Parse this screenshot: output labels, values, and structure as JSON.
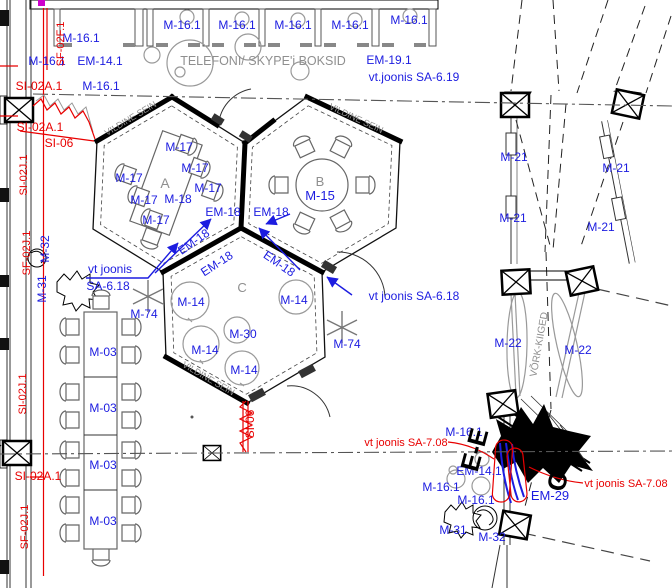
{
  "drawing_type": "architectural floor plan",
  "colors": {
    "annotation_blue": "#1c1ce0",
    "markup_red": "#e80000",
    "dim_gray": "#8f8f8f",
    "wall_black": "#000000",
    "revision_magenta": "#cc00cc"
  },
  "rooms": {
    "booths_title": "TELEFONI/ SKYPE'i BOKSID",
    "hex_a": "A",
    "hex_b": "B",
    "hex_c": "C",
    "felt_wall": "VILDINE SEIN",
    "net_swings": "VÕRK-KIIGED"
  },
  "labels": [
    {
      "n": "booth-label-1",
      "t": "M-16.1",
      "x": 182,
      "y": 29
    },
    {
      "n": "booth-label-2",
      "t": "M-16.1",
      "x": 237,
      "y": 29
    },
    {
      "n": "booth-label-3",
      "t": "M-16.1",
      "x": 293,
      "y": 29
    },
    {
      "n": "booth-label-4",
      "t": "M-16.1",
      "x": 350,
      "y": 29
    },
    {
      "n": "booth-label-5",
      "t": "M-16.1",
      "x": 409,
      "y": 24
    },
    {
      "n": "label-m16-a",
      "t": "M-16.1",
      "x": 81,
      "y": 42
    },
    {
      "n": "label-m16-b",
      "t": "M-16.1",
      "x": 47,
      "y": 65
    },
    {
      "n": "label-em14-top",
      "t": "EM-14.1",
      "x": 100,
      "y": 65
    },
    {
      "n": "label-m16-c",
      "t": "M-16.1",
      "x": 101,
      "y": 90
    },
    {
      "n": "label-si02a-top",
      "t": "SI-02A.1",
      "x": 39,
      "y": 90,
      "c": "r"
    },
    {
      "n": "room-title-booths",
      "t": "TELEFONI/ SKYPE'i BOKSID",
      "x": 263,
      "y": 65,
      "c": "g",
      "s": 12.5
    },
    {
      "n": "label-em19",
      "t": "EM-19.1",
      "x": 389,
      "y": 64
    },
    {
      "n": "label-sa619",
      "t": "vt.joonis SA-6.19",
      "x": 414,
      "y": 81
    },
    {
      "n": "wall-label-a",
      "t": "VILDINE SEIN",
      "x": 132,
      "y": 121,
      "r": -31,
      "c": "g",
      "s": 9
    },
    {
      "n": "wall-label-b",
      "t": "VILDINE SEIN",
      "x": 355,
      "y": 121,
      "r": 25,
      "c": "g",
      "s": 9
    },
    {
      "n": "wall-label-c",
      "t": "VILDINE SEIN",
      "x": 207,
      "y": 381,
      "r": 30,
      "c": "g",
      "s": 9
    },
    {
      "n": "room-letter-a",
      "t": "A",
      "x": 165,
      "y": 188,
      "c": "g",
      "s": 14
    },
    {
      "n": "room-letter-b",
      "t": "B",
      "x": 320,
      "y": 186,
      "c": "g",
      "s": 13
    },
    {
      "n": "room-letter-c",
      "t": "C",
      "x": 242,
      "y": 292,
      "c": "g",
      "s": 13
    },
    {
      "n": "label-m17-1",
      "t": "M-17",
      "x": 179,
      "y": 151
    },
    {
      "n": "label-m17-2",
      "t": "M-17",
      "x": 195,
      "y": 172
    },
    {
      "n": "label-m17-3",
      "t": "M-17",
      "x": 208,
      "y": 192
    },
    {
      "n": "label-m17-4",
      "t": "M-17",
      "x": 129,
      "y": 182
    },
    {
      "n": "label-m17-5",
      "t": "M-17",
      "x": 144,
      "y": 204
    },
    {
      "n": "label-m17-6",
      "t": "M-17",
      "x": 156,
      "y": 224
    },
    {
      "n": "label-m18",
      "t": "M-18",
      "x": 178,
      "y": 203
    },
    {
      "n": "label-m15",
      "t": "M-15",
      "x": 320,
      "y": 200,
      "s": 13
    },
    {
      "n": "label-em18-1",
      "t": "EM-18",
      "x": 223,
      "y": 216
    },
    {
      "n": "label-em18-2",
      "t": "EM-18",
      "x": 271,
      "y": 216
    },
    {
      "n": "label-em18-3",
      "t": "EM-18",
      "x": 196,
      "y": 245,
      "r": -35
    },
    {
      "n": "label-em18-4",
      "t": "EM-18",
      "x": 219,
      "y": 267,
      "r": -33
    },
    {
      "n": "label-em18-5",
      "t": "EM-18",
      "x": 277,
      "y": 267,
      "r": 35
    },
    {
      "n": "label-m14-1",
      "t": "M-14",
      "x": 191,
      "y": 306
    },
    {
      "n": "label-m14-2",
      "t": "M-14",
      "x": 294,
      "y": 304
    },
    {
      "n": "label-m14-3",
      "t": "M-14",
      "x": 205,
      "y": 354
    },
    {
      "n": "label-m14-4",
      "t": "M-14",
      "x": 244,
      "y": 374
    },
    {
      "n": "label-m30",
      "t": "M-30",
      "x": 243,
      "y": 338
    },
    {
      "n": "label-m74-left",
      "t": "M-74",
      "x": 144,
      "y": 318
    },
    {
      "n": "label-m74-right",
      "t": "M-74",
      "x": 347,
      "y": 348
    },
    {
      "n": "label-vtjoonis-left-1",
      "t": "vt joonis",
      "x": 110,
      "y": 273
    },
    {
      "n": "label-vtjoonis-left-2",
      "t": "SA-6.18",
      "x": 108,
      "y": 290
    },
    {
      "n": "label-vtjoonis-right",
      "t": "vt joonis SA-6.18",
      "x": 414,
      "y": 300
    },
    {
      "n": "label-m21-1",
      "t": "M-21",
      "x": 514,
      "y": 161
    },
    {
      "n": "label-m21-2",
      "t": "M-21",
      "x": 616,
      "y": 172
    },
    {
      "n": "label-m21-3",
      "t": "M-21",
      "x": 513,
      "y": 222
    },
    {
      "n": "label-m21-4",
      "t": "M-21",
      "x": 601,
      "y": 231
    },
    {
      "n": "label-m22-left",
      "t": "M-22",
      "x": 508,
      "y": 347
    },
    {
      "n": "label-m22-right",
      "t": "M-22",
      "x": 578,
      "y": 354
    },
    {
      "n": "label-vork-kiiged",
      "t": "VÕRK-KIIGED",
      "x": 542,
      "y": 345,
      "r": -80,
      "c": "g",
      "s": 10
    },
    {
      "n": "label-m03-1",
      "t": "M-03",
      "x": 103,
      "y": 356
    },
    {
      "n": "label-m03-2",
      "t": "M-03",
      "x": 103,
      "y": 412
    },
    {
      "n": "label-m03-3",
      "t": "M-03",
      "x": 103,
      "y": 469
    },
    {
      "n": "label-m03-4",
      "t": "M-03",
      "x": 103,
      "y": 525
    },
    {
      "n": "label-sf02f",
      "t": "SF-02F.1",
      "x": 64,
      "y": 44,
      "r": -90,
      "c": "r",
      "s": 11
    },
    {
      "n": "label-si02j-1",
      "t": "SI-02J.1",
      "x": 27,
      "y": 175,
      "r": -90,
      "c": "r",
      "s": 11
    },
    {
      "n": "label-sf02j-1",
      "t": "SF-02J.1",
      "x": 30,
      "y": 253,
      "r": -90,
      "c": "r",
      "s": 11
    },
    {
      "n": "label-si02j-2",
      "t": "SI-02J.1",
      "x": 26,
      "y": 394,
      "r": -90,
      "c": "r",
      "s": 11
    },
    {
      "n": "label-sf02j-2",
      "t": "SF-02J.1",
      "x": 28,
      "y": 527,
      "r": -90,
      "c": "r",
      "s": 11
    },
    {
      "n": "label-si02a-mid",
      "t": "SI-02A.1",
      "x": 40,
      "y": 131,
      "c": "r"
    },
    {
      "n": "label-si06-left",
      "t": "SI-06",
      "x": 59,
      "y": 147,
      "c": "r"
    },
    {
      "n": "label-si02a-bottom",
      "t": "SI-02A.1",
      "x": 38,
      "y": 480,
      "c": "r"
    },
    {
      "n": "label-si06-bottom",
      "t": "SI-06",
      "x": 254,
      "y": 424,
      "r": -90,
      "c": "r"
    },
    {
      "n": "label-m32-left",
      "t": "M-32",
      "x": 49,
      "y": 249,
      "r": -90
    },
    {
      "n": "label-m31-left",
      "t": "M-31",
      "x": 46,
      "y": 289,
      "r": -90
    },
    {
      "n": "label-sa708-left",
      "t": "vt joonis SA-7.08",
      "x": 406,
      "y": 446,
      "c": "r",
      "s": 11
    },
    {
      "n": "label-sa708-right",
      "t": "vt joonis SA-7.08",
      "x": 626,
      "y": 487,
      "c": "r",
      "s": 11
    },
    {
      "n": "label-m16-bottom-1",
      "t": "M-16.1",
      "x": 464,
      "y": 436
    },
    {
      "n": "label-em14-bottom",
      "t": "EM-14.1",
      "x": 479,
      "y": 475
    },
    {
      "n": "label-m16-bottom-2",
      "t": "M-16.1",
      "x": 441,
      "y": 491
    },
    {
      "n": "label-m16-bottom-3",
      "t": "M-16.1",
      "x": 476,
      "y": 504
    },
    {
      "n": "label-em29",
      "t": "EM-29",
      "x": 550,
      "y": 500,
      "s": 13
    },
    {
      "n": "label-m31-bottom",
      "t": "M-31",
      "x": 453,
      "y": 534
    },
    {
      "n": "label-m32-bottom",
      "t": "M-32",
      "x": 492,
      "y": 541
    },
    {
      "n": "section-ee",
      "t": "E-E",
      "x": 483,
      "y": 452,
      "r": -75,
      "c": "k",
      "s": 26,
      "w": "bold"
    },
    {
      "n": "section-cc",
      "t": "C-C",
      "x": 569,
      "y": 470,
      "r": -78,
      "c": "k",
      "s": 26,
      "w": "bold"
    }
  ]
}
